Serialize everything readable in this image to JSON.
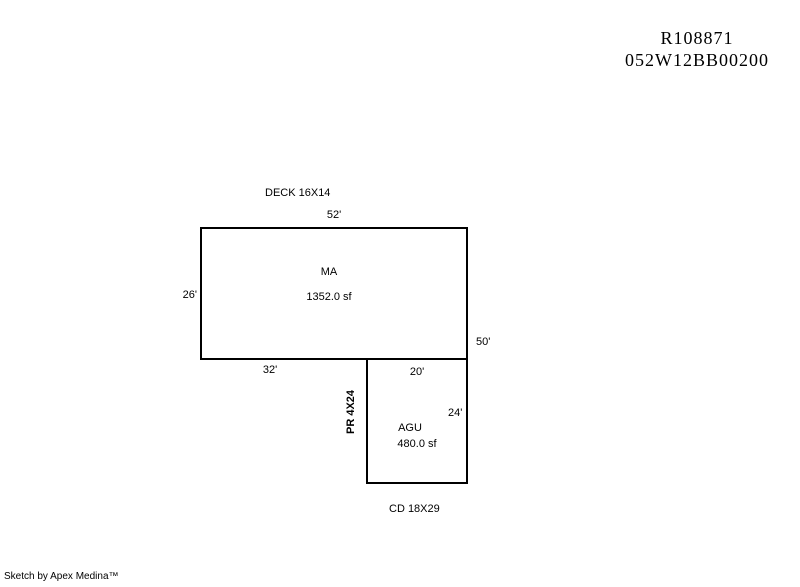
{
  "colors": {
    "background": "#ffffff",
    "line": "#000000",
    "text": "#000000"
  },
  "header": {
    "line1": "R108871",
    "line2": "052W12BB00200"
  },
  "sketch": {
    "deck_label": "DECK 16X14",
    "main_area": {
      "label": "MA",
      "area": "1352.0 sf",
      "dim_top": "52'",
      "dim_left": "26'",
      "dim_right": "50'",
      "dim_bottom": "32'"
    },
    "garage_area": {
      "label": "AGU",
      "area": "480.0 sf",
      "dim_top": "20'",
      "dim_right": "24'",
      "porch_label": "PR 4X24",
      "carport_label": "CD 18X29"
    }
  },
  "footer": {
    "credit": "Sketch by Apex Medina™"
  }
}
